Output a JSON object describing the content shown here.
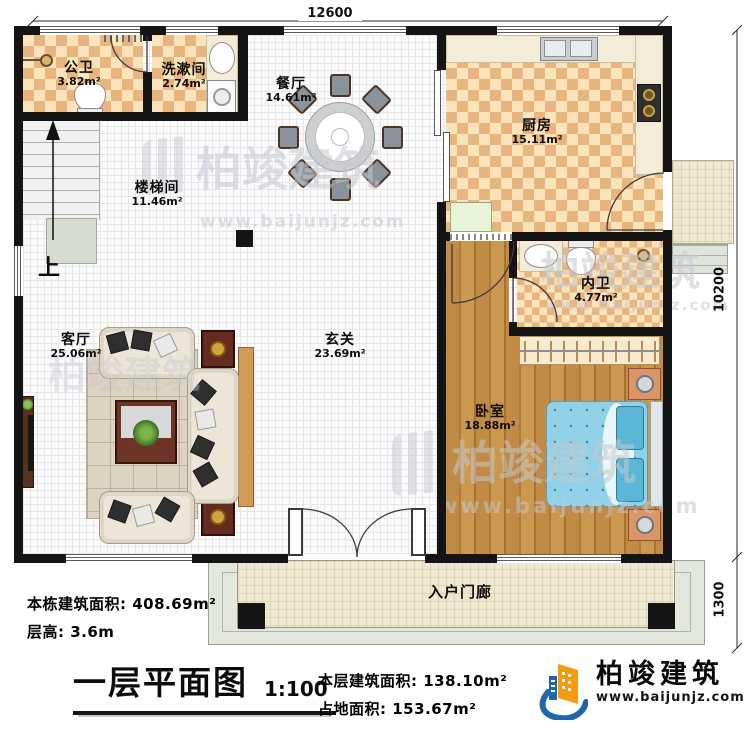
{
  "plan": {
    "dimensions": {
      "top_width": "12600",
      "right_height": "10200",
      "porch_height": "1300"
    },
    "rooms": {
      "public_bath": {
        "name": "公卫",
        "area": "3.82m²"
      },
      "washroom": {
        "name": "洗漱间",
        "area": "2.74m²"
      },
      "dining": {
        "name": "餐厅",
        "area": "14.61m²"
      },
      "kitchen": {
        "name": "厨房",
        "area": "15.11m²"
      },
      "stairwell": {
        "name": "楼梯间",
        "area": "11.46m²"
      },
      "inner_bath": {
        "name": "内卫",
        "area": "4.77m²"
      },
      "living": {
        "name": "客厅",
        "area": "25.06m²"
      },
      "foyer": {
        "name": "玄关",
        "area": "23.69m²"
      },
      "bedroom": {
        "name": "卧室",
        "area": "18.88m²"
      },
      "entry_porch": {
        "name": "入户门廊"
      }
    },
    "stairs_up_label": "上"
  },
  "footer": {
    "building_total_area": "本栋建筑面积: 408.69m²",
    "floor_height": "层高: 3.6m",
    "plan_title": "一层平面图",
    "scale": "1:100",
    "floor_area": "本层建筑面积: 138.10m²",
    "footprint_area": "占地面积: 153.67m²"
  },
  "brand": {
    "name": "柏竣建筑",
    "url": "www.baijunjz.com"
  },
  "watermark": {
    "name": "柏竣建筑",
    "url": "www.baijunjz.com"
  },
  "colors": {
    "wall": "#141414",
    "tile_checker_dark": "#e9b57e",
    "tile_checker_light": "#f9e4bb",
    "wood_floor": "#b9873f",
    "bed_blue": "#8ccfe6",
    "brand_blue": "#1f66ad",
    "brand_orange": "#f39c12",
    "watermark_gray": "#c4c8cf",
    "porch_slab": "#efe9d1"
  }
}
